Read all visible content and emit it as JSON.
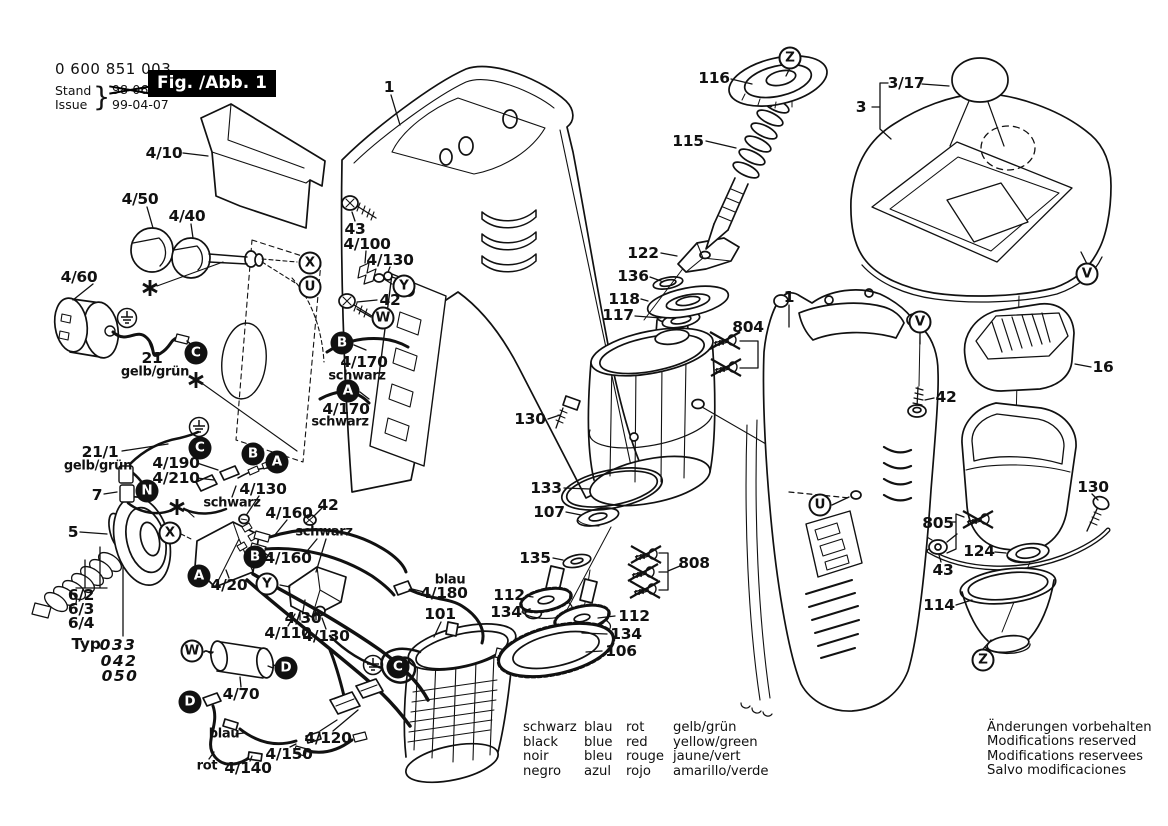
{
  "header": {
    "part_number": "0 600 851 003",
    "stand_label": "Stand",
    "issue_label": "Issue",
    "brace": "}",
    "superseded_date": "98-06",
    "issue_date": "99-04-07",
    "figure_label": "Fig. /Abb. 1"
  },
  "color_legend": {
    "rows": [
      [
        "schwarz",
        "blau",
        "rot",
        "gelb/grün"
      ],
      [
        "black",
        "blue",
        "red",
        "yellow/green"
      ],
      [
        "noir",
        "bleu",
        "rouge",
        "jaune/vert"
      ],
      [
        "negro",
        "azul",
        "rojo",
        "amarillo/verde"
      ]
    ]
  },
  "footnote": {
    "lines": [
      "Änderungen vorbehalten",
      "Modifications reserved",
      "Modifications reservees",
      "Salvo modificaciones"
    ]
  },
  "diagram": {
    "part_labels": [
      {
        "text": "4/10",
        "x": 164,
        "y": 153
      },
      {
        "text": "4/50",
        "x": 140,
        "y": 199
      },
      {
        "text": "4/40",
        "x": 187,
        "y": 216
      },
      {
        "text": "4/60",
        "x": 79,
        "y": 277
      },
      {
        "text": "21",
        "x": 152,
        "y": 358
      },
      {
        "text": "gelb/grün",
        "x": 155,
        "y": 372,
        "small": true
      },
      {
        "text": "43",
        "x": 355,
        "y": 229
      },
      {
        "text": "4/100",
        "x": 367,
        "y": 244
      },
      {
        "text": "4/130",
        "x": 390,
        "y": 260
      },
      {
        "text": "42",
        "x": 390,
        "y": 300
      },
      {
        "text": "4/170",
        "x": 364,
        "y": 362
      },
      {
        "text": "schwarz",
        "x": 357,
        "y": 376,
        "small": true
      },
      {
        "text": "4/170",
        "x": 346,
        "y": 409
      },
      {
        "text": "schwarz",
        "x": 340,
        "y": 422,
        "small": true
      },
      {
        "text": "21/1",
        "x": 100,
        "y": 452
      },
      {
        "text": "gelb/grün",
        "x": 98,
        "y": 466,
        "small": true
      },
      {
        "text": "4/190",
        "x": 176,
        "y": 463
      },
      {
        "text": "4/210",
        "x": 176,
        "y": 478
      },
      {
        "text": "7",
        "x": 97,
        "y": 495
      },
      {
        "text": "schwarz",
        "x": 232,
        "y": 503,
        "small": true
      },
      {
        "text": "4/130",
        "x": 263,
        "y": 489
      },
      {
        "text": "4/160",
        "x": 289,
        "y": 513
      },
      {
        "text": "42",
        "x": 328,
        "y": 505
      },
      {
        "text": "schwarz",
        "x": 324,
        "y": 532,
        "small": true
      },
      {
        "text": "5",
        "x": 73,
        "y": 532
      },
      {
        "text": "4/160",
        "x": 288,
        "y": 558
      },
      {
        "text": "4/20",
        "x": 229,
        "y": 585
      },
      {
        "text": "blau",
        "x": 450,
        "y": 580,
        "small": true
      },
      {
        "text": "4/180",
        "x": 444,
        "y": 593
      },
      {
        "text": "101",
        "x": 440,
        "y": 614
      },
      {
        "text": "4/30",
        "x": 303,
        "y": 618
      },
      {
        "text": "4/110",
        "x": 288,
        "y": 633
      },
      {
        "text": "4/130",
        "x": 326,
        "y": 636
      },
      {
        "text": "6/2",
        "x": 81,
        "y": 595
      },
      {
        "text": "6/3",
        "x": 81,
        "y": 609
      },
      {
        "text": "6/4",
        "x": 81,
        "y": 623
      },
      {
        "text": "Typ",
        "x": 86,
        "y": 644
      },
      {
        "text": "033",
        "x": 118,
        "y": 645,
        "italic": true
      },
      {
        "text": "042",
        "x": 119,
        "y": 661,
        "italic": true
      },
      {
        "text": "050",
        "x": 120,
        "y": 676,
        "italic": true
      },
      {
        "text": "4/70",
        "x": 241,
        "y": 694
      },
      {
        "text": "blau",
        "x": 224,
        "y": 734,
        "small": true
      },
      {
        "text": "4/120",
        "x": 328,
        "y": 738
      },
      {
        "text": "4/150",
        "x": 289,
        "y": 754
      },
      {
        "text": "rot",
        "x": 207,
        "y": 766,
        "small": true
      },
      {
        "text": "4/140",
        "x": 248,
        "y": 768
      },
      {
        "text": "1",
        "x": 389,
        "y": 87
      },
      {
        "text": "116",
        "x": 714,
        "y": 78
      },
      {
        "text": "115",
        "x": 688,
        "y": 141
      },
      {
        "text": "122",
        "x": 643,
        "y": 253
      },
      {
        "text": "136",
        "x": 633,
        "y": 276
      },
      {
        "text": "118",
        "x": 624,
        "y": 299
      },
      {
        "text": "117",
        "x": 618,
        "y": 315
      },
      {
        "text": "804",
        "x": 748,
        "y": 327
      },
      {
        "text": "1",
        "x": 789,
        "y": 297
      },
      {
        "text": "130",
        "x": 530,
        "y": 419
      },
      {
        "text": "133",
        "x": 546,
        "y": 488
      },
      {
        "text": "107",
        "x": 549,
        "y": 512
      },
      {
        "text": "135",
        "x": 535,
        "y": 558
      },
      {
        "text": "808",
        "x": 694,
        "y": 563
      },
      {
        "text": "112",
        "x": 509,
        "y": 595
      },
      {
        "text": "134",
        "x": 506,
        "y": 612
      },
      {
        "text": "112",
        "x": 634,
        "y": 616
      },
      {
        "text": "134",
        "x": 626,
        "y": 634
      },
      {
        "text": "106",
        "x": 621,
        "y": 651
      },
      {
        "text": "3/17",
        "x": 906,
        "y": 83
      },
      {
        "text": "3",
        "x": 861,
        "y": 107
      },
      {
        "text": "16",
        "x": 1103,
        "y": 367
      },
      {
        "text": "42",
        "x": 946,
        "y": 397
      },
      {
        "text": "805",
        "x": 938,
        "y": 523
      },
      {
        "text": "124",
        "x": 979,
        "y": 551
      },
      {
        "text": "43",
        "x": 943,
        "y": 570
      },
      {
        "text": "130",
        "x": 1093,
        "y": 487
      },
      {
        "text": "114",
        "x": 939,
        "y": 605
      }
    ],
    "callouts": [
      {
        "letter": "C",
        "x": 196,
        "y": 353,
        "filled": true
      },
      {
        "letter": "X",
        "x": 310,
        "y": 263,
        "filled": false
      },
      {
        "letter": "U",
        "x": 310,
        "y": 287,
        "filled": false
      },
      {
        "letter": "Y",
        "x": 404,
        "y": 286,
        "filled": false
      },
      {
        "letter": "W",
        "x": 383,
        "y": 318,
        "filled": false
      },
      {
        "letter": "B",
        "x": 342,
        "y": 343,
        "filled": true
      },
      {
        "letter": "A",
        "x": 348,
        "y": 391,
        "filled": true
      },
      {
        "letter": "C",
        "x": 200,
        "y": 448,
        "filled": true
      },
      {
        "letter": "B",
        "x": 253,
        "y": 454,
        "filled": true
      },
      {
        "letter": "A",
        "x": 277,
        "y": 462,
        "filled": true
      },
      {
        "letter": "N",
        "x": 147,
        "y": 491,
        "filled": true
      },
      {
        "letter": "X",
        "x": 170,
        "y": 533,
        "filled": false
      },
      {
        "letter": "B",
        "x": 255,
        "y": 557,
        "filled": true
      },
      {
        "letter": "A",
        "x": 199,
        "y": 576,
        "filled": true
      },
      {
        "letter": "Y",
        "x": 267,
        "y": 584,
        "filled": false
      },
      {
        "letter": "W",
        "x": 192,
        "y": 651,
        "filled": false
      },
      {
        "letter": "D",
        "x": 286,
        "y": 668,
        "filled": true
      },
      {
        "letter": "D",
        "x": 190,
        "y": 702,
        "filled": true
      },
      {
        "letter": "C",
        "x": 398,
        "y": 667,
        "filled": true
      },
      {
        "letter": "Z",
        "x": 790,
        "y": 58,
        "filled": false
      },
      {
        "letter": "V",
        "x": 1087,
        "y": 274,
        "filled": false
      },
      {
        "letter": "V",
        "x": 920,
        "y": 322,
        "filled": false
      },
      {
        "letter": "U",
        "x": 820,
        "y": 505,
        "filled": false
      },
      {
        "letter": "Z",
        "x": 983,
        "y": 660,
        "filled": false
      }
    ],
    "ground_symbols": [
      {
        "x": 127,
        "y": 318
      },
      {
        "x": 199,
        "y": 427
      },
      {
        "x": 373,
        "y": 665
      }
    ],
    "asterisks": [
      {
        "x": 150,
        "y": 288
      },
      {
        "x": 196,
        "y": 380
      },
      {
        "x": 177,
        "y": 507
      }
    ],
    "unavailable_part_marks": [
      {
        "x": 725,
        "y": 341
      },
      {
        "x": 726,
        "y": 368
      },
      {
        "x": 646,
        "y": 555
      },
      {
        "x": 643,
        "y": 573
      },
      {
        "x": 645,
        "y": 590
      },
      {
        "x": 978,
        "y": 520
      }
    ]
  }
}
